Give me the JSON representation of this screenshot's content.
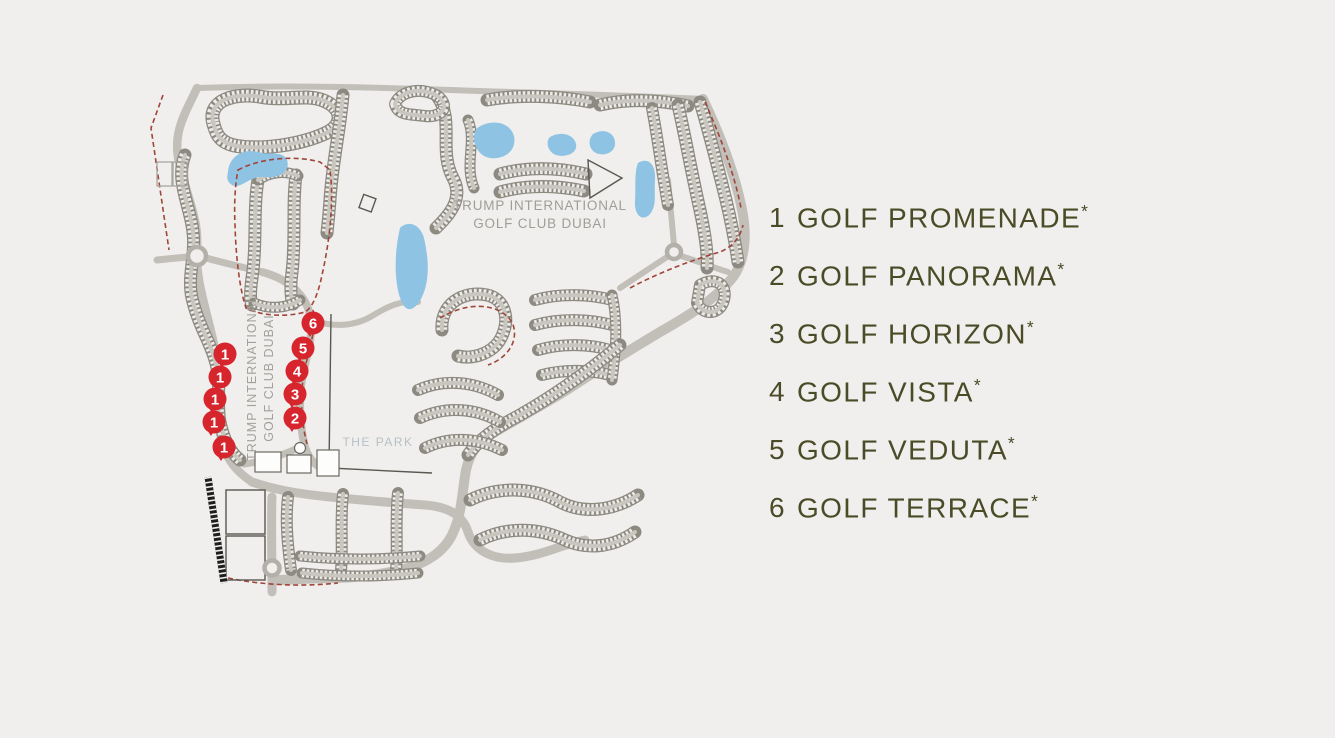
{
  "figure": {
    "background": "#f0efed"
  },
  "legend": {
    "text_color": "#4a4c27",
    "items": [
      {
        "number": "1",
        "name": "GOLF PROMENADE",
        "suffix": "*"
      },
      {
        "number": "2",
        "name": "GOLF PANORAMA",
        "suffix": "*"
      },
      {
        "number": "3",
        "name": "GOLF HORIZON",
        "suffix": "*"
      },
      {
        "number": "4",
        "name": "GOLF VISTA",
        "suffix": "*"
      },
      {
        "number": "5",
        "name": "GOLF VEDUTA",
        "suffix": "*"
      },
      {
        "number": "6",
        "name": "GOLF TERRACE",
        "suffix": "*"
      }
    ]
  },
  "map": {
    "club_label": {
      "line1": "TRUMP INTERNATIONAL",
      "line2": "GOLF CLUB DUBAI"
    },
    "club_label_vertical": {
      "line1": "TRUMP INTERNATIONAL",
      "line2": "GOLF CLUB DUBAI"
    },
    "park_label": "THE PARK",
    "colors": {
      "pin": "#d6252c",
      "lake": "#8fc3e4",
      "road": "#c2bfb9",
      "cluster": "#8d8a81",
      "boundary_dash": "#a0453a",
      "label_gray": "#a19e99"
    },
    "markers": [
      {
        "label": "1",
        "x": 225,
        "y": 354
      },
      {
        "label": "1",
        "x": 220,
        "y": 377
      },
      {
        "label": "1",
        "x": 215,
        "y": 399
      },
      {
        "label": "1",
        "x": 214,
        "y": 422
      },
      {
        "label": "1",
        "x": 224,
        "y": 447
      },
      {
        "label": "2",
        "x": 295,
        "y": 418
      },
      {
        "label": "3",
        "x": 295,
        "y": 394
      },
      {
        "label": "4",
        "x": 297,
        "y": 371
      },
      {
        "label": "5",
        "x": 303,
        "y": 348
      },
      {
        "label": "6",
        "x": 313,
        "y": 323
      }
    ]
  }
}
